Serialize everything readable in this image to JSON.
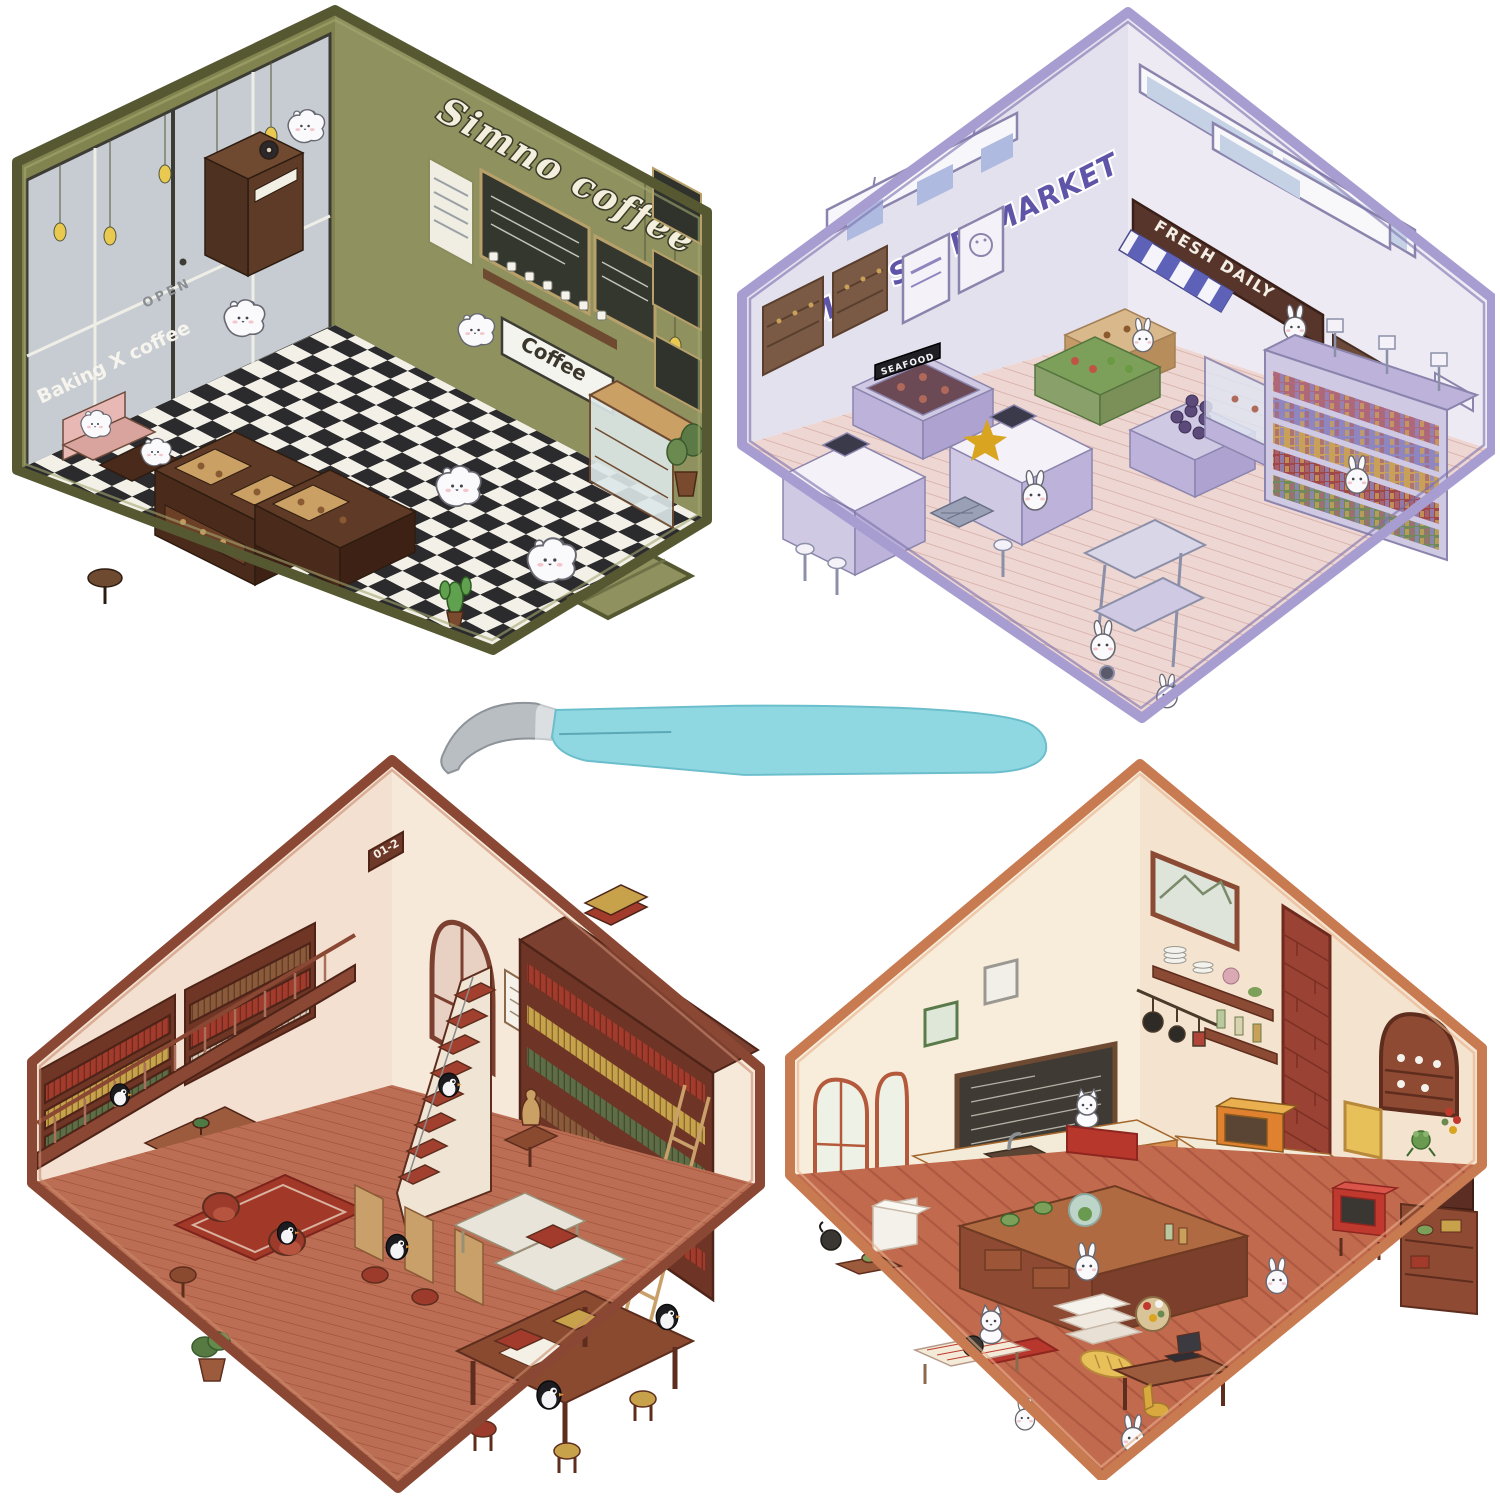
{
  "scenes": {
    "coffee": {
      "title": "Simno coffee",
      "window_sign": "Baking X coffee",
      "door_sign": "OPEN",
      "counter_sign": "Coffee",
      "palette": {
        "frame": "#565832",
        "wall": "#8a8c5c",
        "floor_light": "#f3f0e8",
        "floor_dark": "#2b2b2e",
        "wood": "#5c3a26"
      }
    },
    "supermarket": {
      "title": "SIMNO SUPERMARKET",
      "awning_sign": "FRESH DAILY",
      "bin_sign": "SEAFOOD",
      "palette": {
        "frame": "#a89dd0",
        "wall": "#e9e6f1",
        "floor": "#eed7d2",
        "accent": "#5f55a8"
      }
    },
    "bookstore": {
      "wall_sign": "01-2",
      "palette": {
        "frame": "#8a4733",
        "wall": "#f7e9da",
        "floor": "#bb6e53",
        "shelf": "#6f3625"
      }
    },
    "kitchen": {
      "palette": {
        "frame": "#c87a50",
        "wall": "#f8eddb",
        "floor": "#c16a4e",
        "brick": "#9a4233"
      }
    }
  },
  "tool": {
    "handle_color": "#8fd8e2",
    "tip_color": "#b9bec3"
  }
}
